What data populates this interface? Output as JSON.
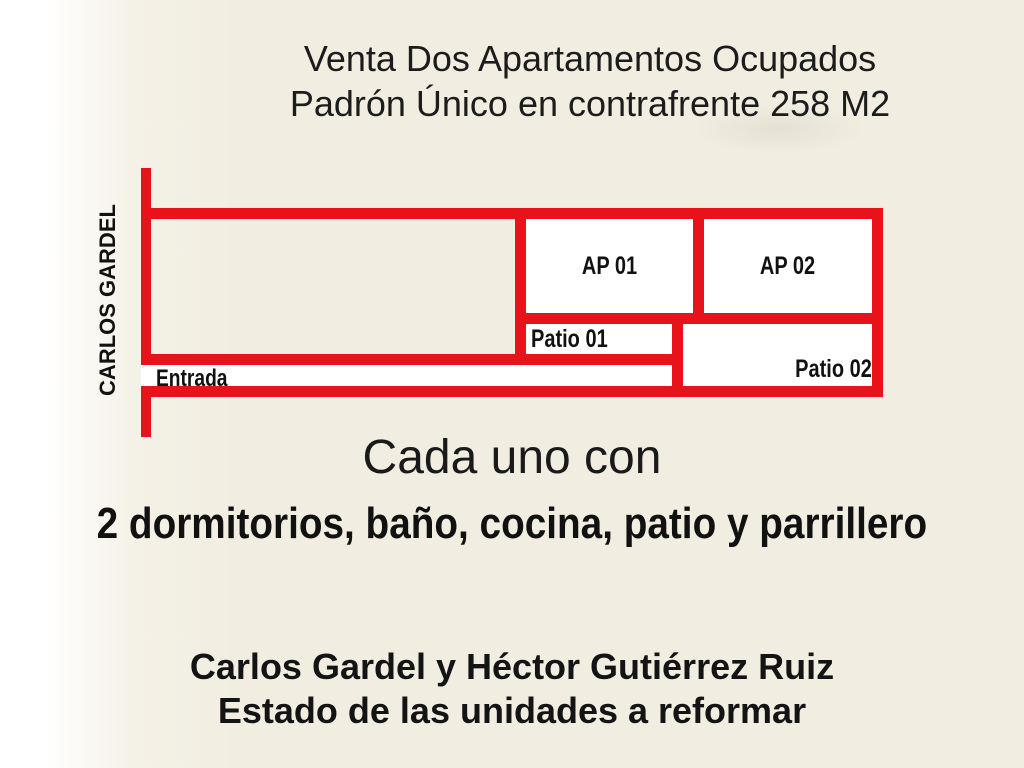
{
  "slide": {
    "title_line1": "Venta Dos Apartamentos Ocupados",
    "title_line2": "Padrón Único en contrafrente 258 M2",
    "heading": "Cada uno con",
    "features": "2 dormitorios, baño, cocina, patio y parrillero",
    "footer_line1": "Carlos Gardel y Héctor Gutiérrez Ruiz",
    "footer_line2": "Estado de las unidades a reformar"
  },
  "plan": {
    "street_label": "CARLOS GARDEL",
    "entrance_label": "Entrada",
    "apartment1_label": "AP 01",
    "apartment2_label": "AP 02",
    "patio1_label": "Patio 01",
    "patio2_label": "Patio 02"
  },
  "colors": {
    "background": "#f1eee1",
    "left_edge_light": "#ffffff",
    "plan_line_red": "#e8131a",
    "room_fill": "#ffffff",
    "text": "#1b1b1b"
  }
}
